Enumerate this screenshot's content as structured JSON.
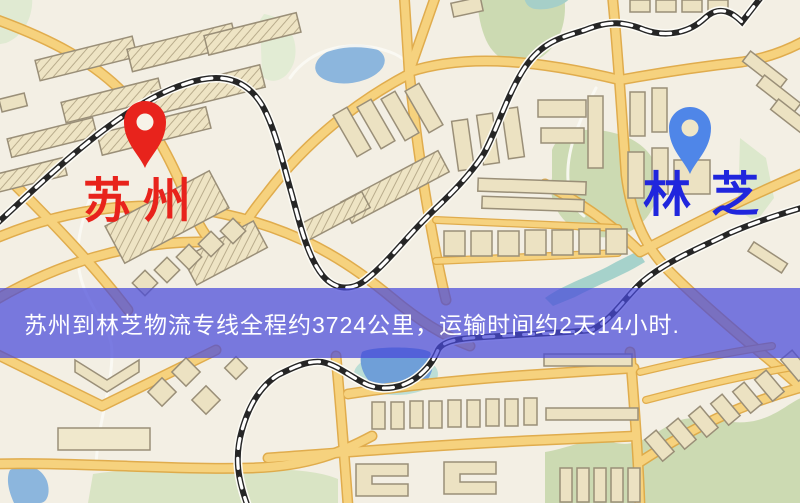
{
  "map": {
    "labels": {
      "origin": "苏州",
      "destination": "林芝"
    },
    "markers": {
      "origin": {
        "icon": "red-pin",
        "color": "#e8231c"
      },
      "destination": {
        "icon": "blue-pin",
        "color": "#4f86e8"
      }
    },
    "colors": {
      "background": "#f3efe4",
      "road_fill": "#f6d27e",
      "road_casing": "#dfa945",
      "park": "#ccdab2",
      "water": "#8cb6dd",
      "lake": "#6f9fd8",
      "railway": "#262626",
      "building_fill": "#ece2c2",
      "building_stroke": "#9a8f78",
      "origin_label": "#e8231c",
      "destination_label": "#2026dd",
      "banner_background": "#484ada",
      "banner_text": "#ffffff"
    }
  },
  "banner": {
    "text": "苏州到林芝物流专线全程约3724公里，运输时间约2天14小时."
  }
}
